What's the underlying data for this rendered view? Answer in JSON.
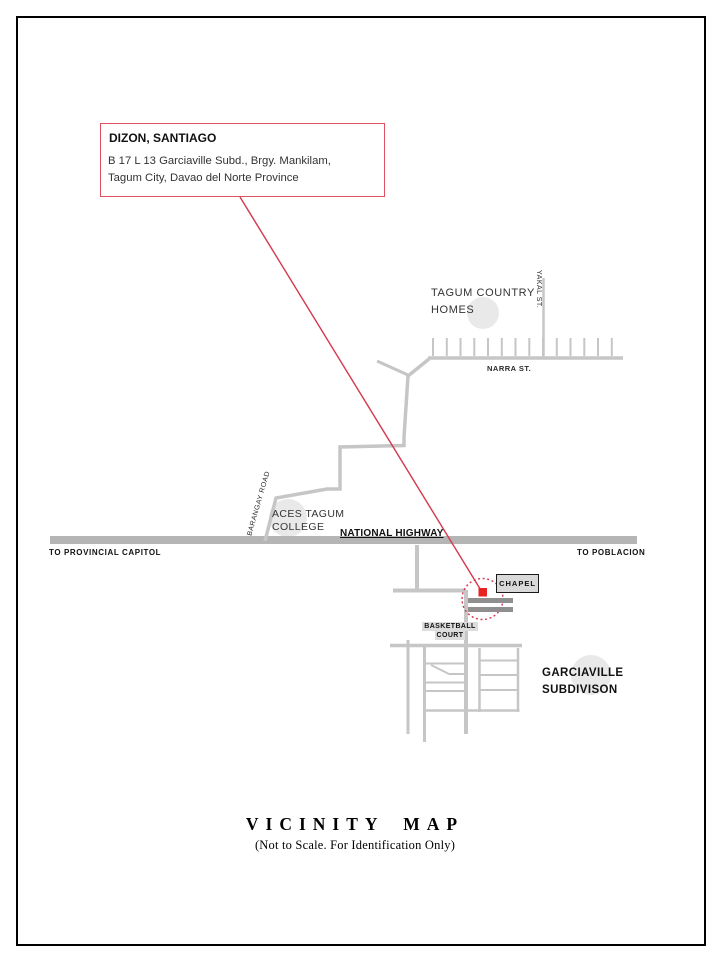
{
  "info_box": {
    "name": "DIZON, SANTIAGO",
    "address_line1": "B 17 L 13 Garciaville Subd., Brgy. Mankilam,",
    "address_line2": "Tagum City, Davao del Norte Province"
  },
  "labels": {
    "tagum_country_homes_line1": "TAGUM COUNTRY",
    "tagum_country_homes_line2": "HOMES",
    "yakal_st": "YAKAL ST.",
    "narra_st": "NARRA ST.",
    "barangay_road": "BARANGAY ROAD",
    "aces_line1": "ACES TAGUM",
    "aces_line2": "COLLEGE",
    "national_highway": "NATIONAL HIGHWAY",
    "to_provincial_capitol": "TO PROVINCIAL CAPITOL",
    "to_poblacion": "TO POBLACION",
    "chapel": "CHAPEL",
    "basketball_line1": "BASKETBALL",
    "basketball_line2": "COURT",
    "garciaville_line1": "GARCIAVILLE",
    "garciaville_line2": "SUBDIVISON"
  },
  "title": {
    "main": "VICINITY MAP",
    "subtitle": "(Not to Scale. For Identification Only)"
  },
  "colors": {
    "accent_red": "#d5374f",
    "marker_red": "#e62222",
    "road_gray": "#c6c6c6",
    "highway_gray": "#b5b5b5",
    "block_gray": "#8f8f8f"
  }
}
